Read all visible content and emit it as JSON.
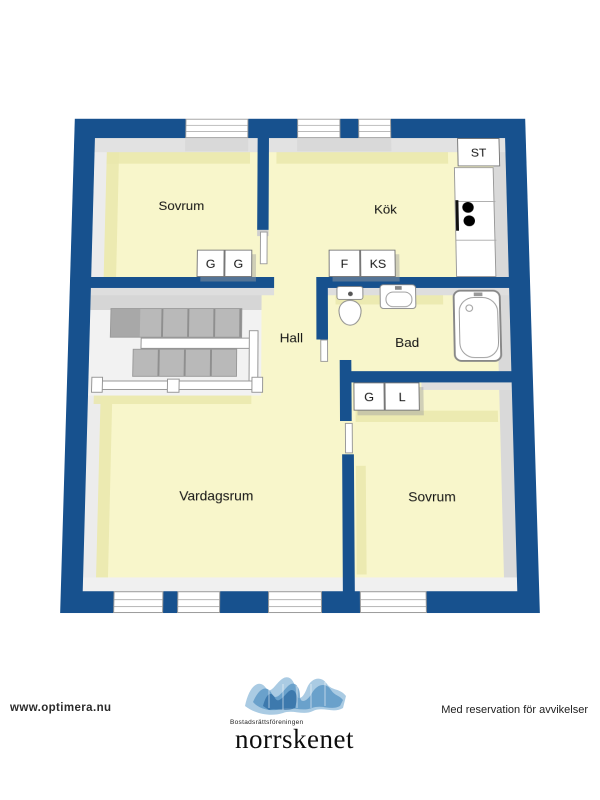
{
  "plan": {
    "rooms": {
      "sovrum1": "Sovrum",
      "kok": "Kök",
      "hall": "Hall",
      "bad": "Bad",
      "vardagsrum": "Vardagsrum",
      "sovrum2": "Sovrum"
    },
    "storage": {
      "g1": "G",
      "g2": "G",
      "f": "F",
      "ks": "KS",
      "st": "ST",
      "g3": "G",
      "l": "L"
    },
    "fixtures": {
      "stairs-icon": "u-shaped-staircase",
      "toilet-icon": "toilet",
      "sink-icon": "washbasin",
      "bathtub-icon": "bathtub",
      "stove-icon": "stove-burners",
      "counter-icon": "kitchen-counter",
      "railing-icon": "stair-railing",
      "window-icon": "window"
    },
    "colors": {
      "wall": "#17518e",
      "floor": "#f8f6cb",
      "floor_shadow": "#eae7ad",
      "wall_face": "#e2e2e2"
    }
  },
  "footer": {
    "website": "www.optimera.nu",
    "disclaimer": "Med reservation för avvikelser",
    "logo_small": "Bostadsrättsföreningen",
    "logo_large": "norrskenet"
  }
}
